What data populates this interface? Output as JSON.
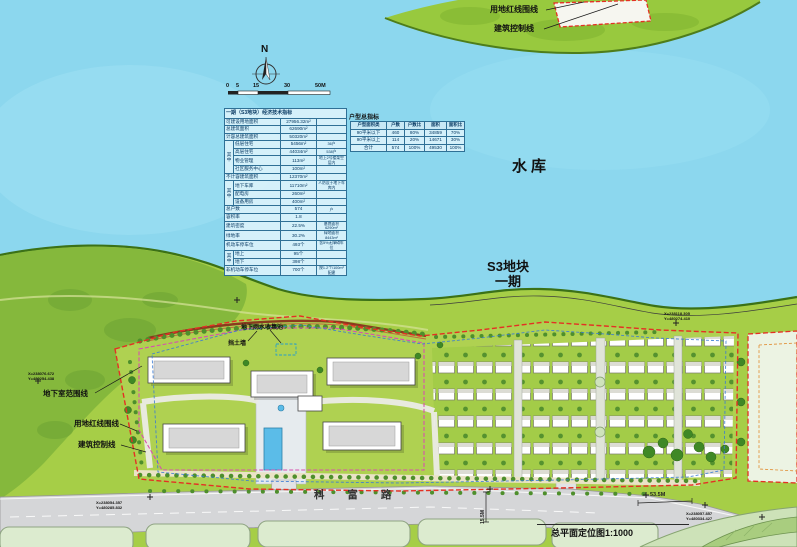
{
  "compass": {
    "north": "N"
  },
  "scale_bar": {
    "t0": "0",
    "t1": "5",
    "t2": "15",
    "t3": "30",
    "t4": "50M"
  },
  "water": {
    "label": "水库"
  },
  "phase": {
    "line1": "S3地块",
    "line2": "一期"
  },
  "road": {
    "name": "科 富 路"
  },
  "title_block": {
    "drawing_title": "总平面定位图1:1000"
  },
  "callouts": {
    "top_red": "用地红线围线",
    "top_ctrl": "建筑控制线",
    "left_basement": "地下室范围线",
    "left_red": "用地红线围线",
    "left_ctrl": "建筑控制线",
    "rainwater": "地下雨水收集池",
    "retaining_wall": "挡土墙"
  },
  "dimensions": {
    "road_width": "53.5M",
    "entry_width": "15.5M"
  },
  "coordinates": {
    "bottom_left": {
      "x": "X=238054.357",
      "y": "Y=480285.832"
    },
    "bottom_right": {
      "x": "X=238057.857",
      "y": "Y=480334.427"
    },
    "east": {
      "x": "X=238118.305",
      "y": "Y=480274.410"
    },
    "northwest": {
      "x": "X=238076.672",
      "y": "Y=480254.438"
    }
  },
  "econ_table": {
    "title": "一期（S3地块）经济技术指标",
    "among": "其中",
    "rows": [
      {
        "label": "可建设用地面积",
        "value": "27956.32m²",
        "note": ""
      },
      {
        "label": "总建筑面积",
        "value": "62690m²",
        "note": ""
      },
      {
        "label": "计容总建筑面积",
        "value": "50320m²",
        "note": ""
      },
      {
        "label": "低层住宅",
        "value": "5456m²",
        "note": "36户"
      },
      {
        "label": "高层住宅",
        "value": "44034m²",
        "note": "538户"
      },
      {
        "label": "物业管理",
        "value": "113m²",
        "note": "地上2号楼架空层内"
      },
      {
        "label": "社区服务中心",
        "value": "100m²",
        "note": ""
      },
      {
        "label": "不计容建筑面积",
        "value": "12370m²",
        "note": ""
      },
      {
        "label": "地下车库",
        "value": "11710m²",
        "note": "人防设于地下车库内"
      },
      {
        "label": "配电房",
        "value": "260m²",
        "note": ""
      },
      {
        "label": "设备用房",
        "value": "400m²",
        "note": ""
      },
      {
        "label": "总户数",
        "value": "574",
        "note": "户"
      },
      {
        "label": "容积率",
        "value": "1.8",
        "note": ""
      },
      {
        "label": "建筑密度",
        "value": "22.5%",
        "note": "基底面积6290m²"
      },
      {
        "label": "绿地率",
        "value": "30.2%",
        "note": "绿地面积8443m²"
      },
      {
        "label": "机动车停车位",
        "value": "493个",
        "note": "含5%无障碍车位"
      },
      {
        "label": "地上",
        "value": "95个",
        "note": ""
      },
      {
        "label": "地下",
        "value": "398个",
        "note": ""
      },
      {
        "label": "非机动车停车位",
        "value": "700个",
        "note": "按1.2个/100m²配建"
      }
    ]
  },
  "unit_table": {
    "title": "户型总指标",
    "headers": [
      "户型面积类",
      "户数",
      "户数比",
      "面积",
      "面积比"
    ],
    "rows": [
      [
        "90平米以下",
        "460",
        "80%",
        "34859",
        "70%"
      ],
      [
        "90平米以上",
        "114",
        "20%",
        "14671",
        "30%"
      ],
      [
        "合计",
        "574",
        "100%",
        "49530",
        "100%"
      ]
    ]
  },
  "colors": {
    "water": "#8CD7EE",
    "land": "#A6CE47",
    "red_line": "#E43024",
    "control_line": "#3A7BD5",
    "basement_line": "#D84FAE"
  }
}
